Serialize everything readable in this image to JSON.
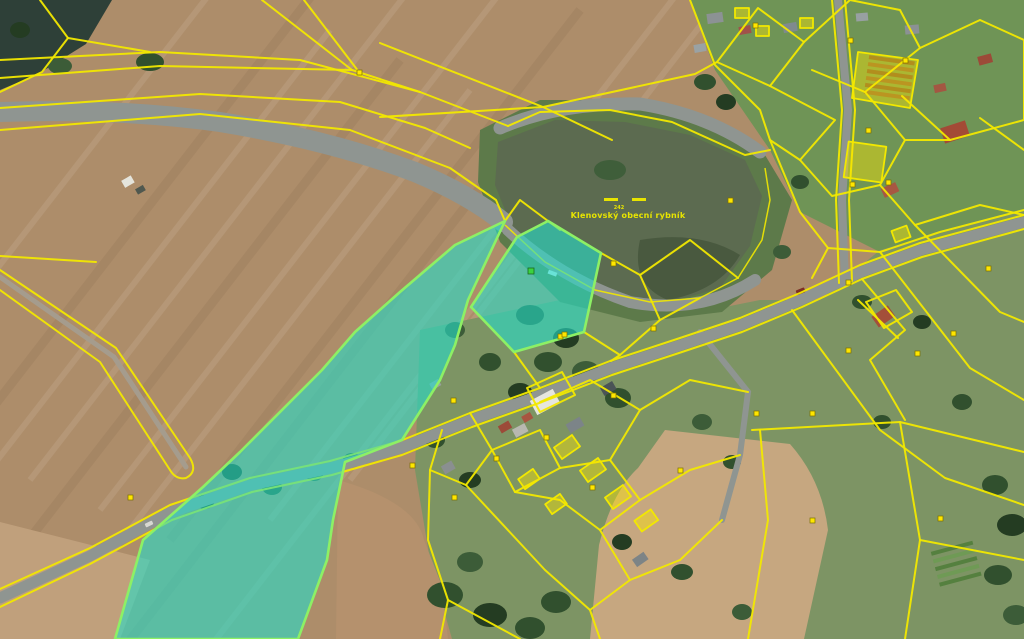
{
  "map": {
    "pond": {
      "label": "Klenovský obecní rybník",
      "parcel_number": "242"
    }
  },
  "icons": {
    "parcel_marker": "parcel-marker",
    "highlight_marker": "highlighted-parcel-marker",
    "water_dashes": "water-area-dashes"
  },
  "colors": {
    "cadastral_line": "#f2e800",
    "cadastral_fill": "rgba(255,230,0,0.42)",
    "highlight_fill": "rgba(37,221,201,0.60)",
    "highlight_stroke": "#8df065",
    "marker_fill": "#ffe600",
    "marker_green": "#3bd23f",
    "label_yellow": "#e8e400",
    "field_brown": "#ad8d6a",
    "field_tan": "#c6a780",
    "meadow_green": "#6f9456",
    "village_green": "#7d9464",
    "forest_green": "#31502e",
    "pond_water": "#5c6b50",
    "road_grey": "#8f9591"
  }
}
